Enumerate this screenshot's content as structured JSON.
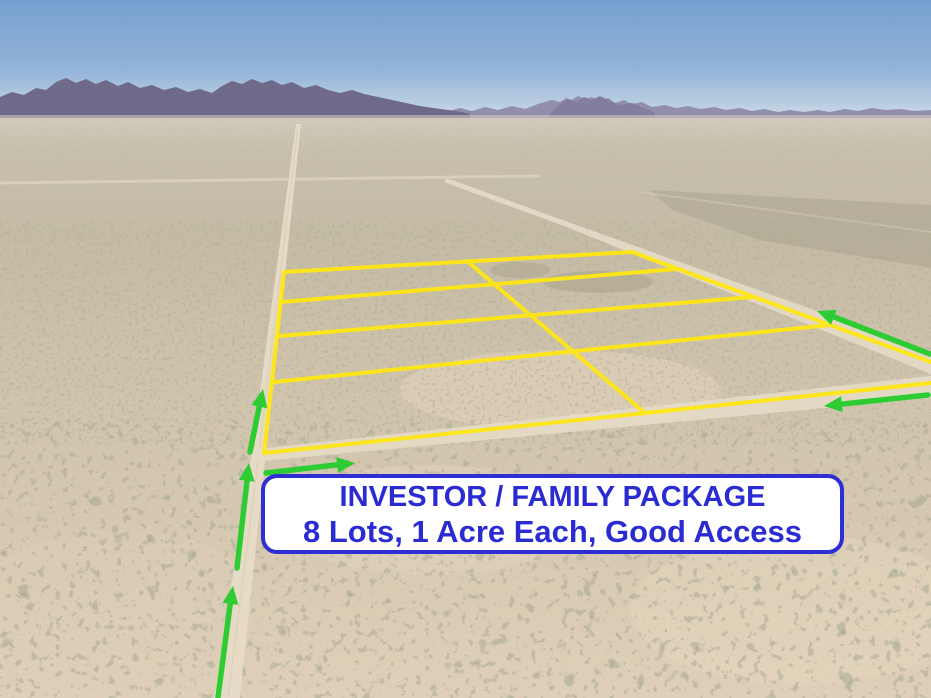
{
  "banner": {
    "line1": "INVESTOR / FAMILY PACKAGE",
    "line2": "8 Lots, 1 Acre Each, Good Access"
  },
  "colors": {
    "lot_outline": "#ffe712",
    "arrow": "#2ecc33",
    "banner_text": "#2b2bd4",
    "banner_border": "#2e2ed4",
    "banner_bg": "#ffffff",
    "sky_top": "#76a0d0",
    "mountains": "#6f6a89",
    "desert_sand": "#d6c8b0",
    "road": "#e6dbc7"
  }
}
